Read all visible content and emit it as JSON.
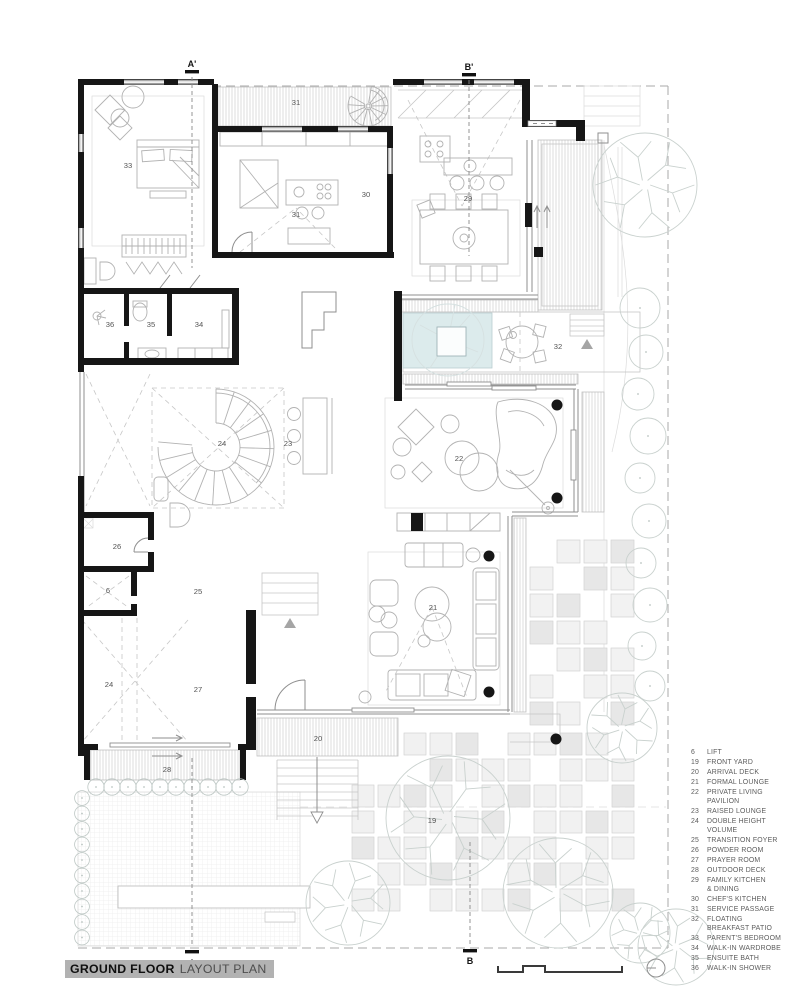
{
  "title": {
    "bold": "GROUND FLOOR",
    "regular": "LAYOUT PLAN"
  },
  "legend": {
    "items": [
      {
        "num": "6",
        "label": "LIFT"
      },
      {
        "num": "19",
        "label": "FRONT YARD"
      },
      {
        "num": "20",
        "label": "ARRIVAL DECK"
      },
      {
        "num": "21",
        "label": "FORMAL LOUNGE"
      },
      {
        "num": "22",
        "label": "PRIVATE LIVING\nPAVILION"
      },
      {
        "num": "23",
        "label": "RAISED LOUNGE"
      },
      {
        "num": "24",
        "label": "DOUBLE HEIGHT\nVOLUME"
      },
      {
        "num": "25",
        "label": "TRANSITION FOYER"
      },
      {
        "num": "26",
        "label": "POWDER ROOM"
      },
      {
        "num": "27",
        "label": "PRAYER ROOM"
      },
      {
        "num": "28",
        "label": "OUTDOOR DECK"
      },
      {
        "num": "29",
        "label": "FAMILY KITCHEN\n& DINING"
      },
      {
        "num": "30",
        "label": "CHEF'S KITCHEN"
      },
      {
        "num": "31",
        "label": "SERVICE PASSAGE"
      },
      {
        "num": "32",
        "label": "FLOATING\nBREAKFAST PATIO"
      },
      {
        "num": "33",
        "label": "PARENT'S BEDROOM"
      },
      {
        "num": "34",
        "label": "WALK-IN WARDROBE"
      },
      {
        "num": "35",
        "label": "ENSUITE BATH"
      },
      {
        "num": "36",
        "label": "WALK-IN SHOWER"
      }
    ]
  },
  "plan": {
    "room_labels": [
      {
        "label": "33",
        "x": 128,
        "y": 165
      },
      {
        "label": "31",
        "x": 296,
        "y": 102
      },
      {
        "label": "30",
        "x": 366,
        "y": 194
      },
      {
        "label": "31",
        "x": 296,
        "y": 214
      },
      {
        "label": "29",
        "x": 468,
        "y": 198
      },
      {
        "label": "36",
        "x": 110,
        "y": 324
      },
      {
        "label": "35",
        "x": 151,
        "y": 324
      },
      {
        "label": "34",
        "x": 199,
        "y": 324
      },
      {
        "label": "32",
        "x": 558,
        "y": 346
      },
      {
        "label": "24",
        "x": 222,
        "y": 443
      },
      {
        "label": "23",
        "x": 288,
        "y": 443
      },
      {
        "label": "22",
        "x": 459,
        "y": 458
      },
      {
        "label": "26",
        "x": 117,
        "y": 546
      },
      {
        "label": "6",
        "x": 108,
        "y": 590
      },
      {
        "label": "25",
        "x": 198,
        "y": 591
      },
      {
        "label": "21",
        "x": 433,
        "y": 607
      },
      {
        "label": "24",
        "x": 109,
        "y": 684
      },
      {
        "label": "27",
        "x": 198,
        "y": 689
      },
      {
        "label": "28",
        "x": 167,
        "y": 769
      },
      {
        "label": "20",
        "x": 318,
        "y": 738
      },
      {
        "label": "19",
        "x": 432,
        "y": 820
      }
    ],
    "section_markers": [
      {
        "label": "A'",
        "x": 192,
        "y": 67,
        "bar_y": 70,
        "dash": [
          77,
          268
        ]
      },
      {
        "label": "B'",
        "x": 469,
        "y": 70,
        "bar_y": 73,
        "dash": [
          80,
          256
        ]
      },
      {
        "label": "A",
        "x": 192,
        "y": 966,
        "bar_y": 950,
        "dash": [
          758,
          946
        ]
      },
      {
        "label": "B",
        "x": 470,
        "y": 964,
        "bar_y": 949,
        "dash": [
          842,
          946
        ]
      }
    ]
  },
  "colors": {
    "wall": "#161616",
    "thin_line": "#8f8f8f",
    "light_line": "#c6c6c6",
    "water": "#dcebec",
    "stone_fill": "#f1f1f1",
    "stone_dark": "#e7e7e7",
    "tree": "#c9d1ce",
    "title_bg": "#b2b2b2",
    "legend_text": "#5c5c5c"
  }
}
